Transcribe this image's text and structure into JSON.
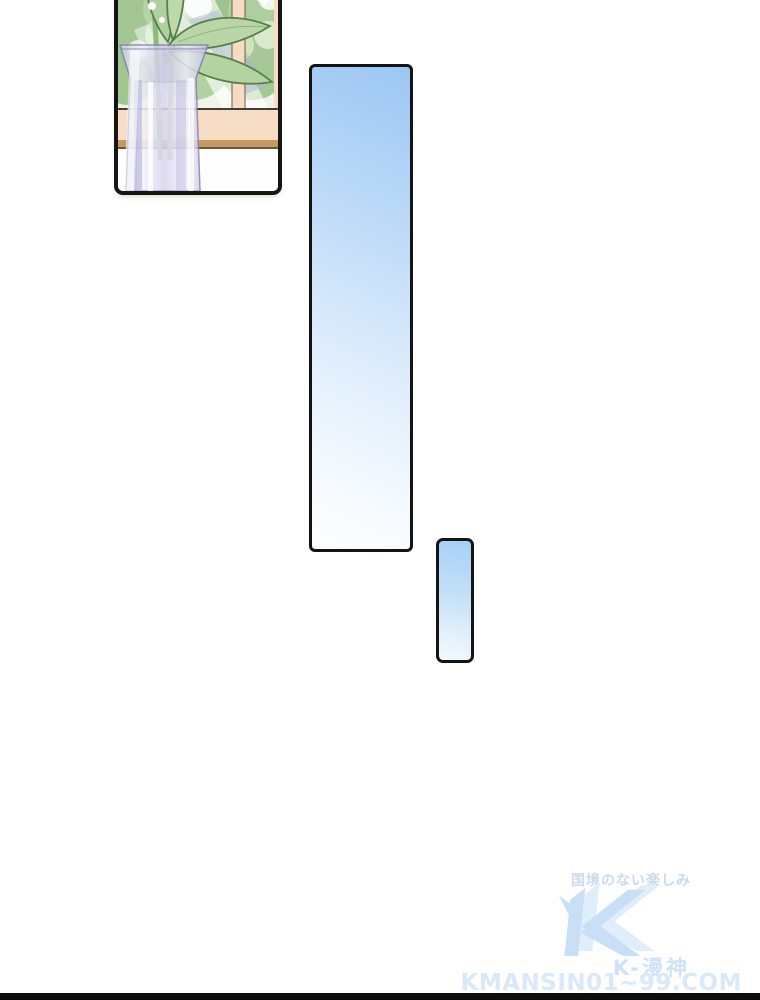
{
  "page": {
    "background_color": "#ffffff",
    "bottom_bar_color": "#0d0d0d"
  },
  "panels": {
    "plant_panel": {
      "border_color": "#151515",
      "window_frame_color": "#f6dcc3",
      "sill_wood_color": "#c49a62",
      "foliage_color": "#a3c792",
      "leaf_color": "#b9d7a6",
      "vase_tint_color": "#c9c6e8"
    },
    "tall_bubble": {
      "fill_top": "#9cc6f3",
      "fill_bottom": "#fdfeff",
      "border_color": "#141414"
    },
    "small_bubble": {
      "fill_top": "#a6cff6",
      "fill_bottom": "#f2fafd",
      "border_color": "#141414"
    }
  },
  "watermark": {
    "tagline": "国境のない楽しみ",
    "brand": "K-漫神",
    "site": "KMANSIN01~99.COM",
    "text_color": "#d3e5f8",
    "logo_front_color": "#c9dff6",
    "logo_back_color": "#e0edfb"
  }
}
